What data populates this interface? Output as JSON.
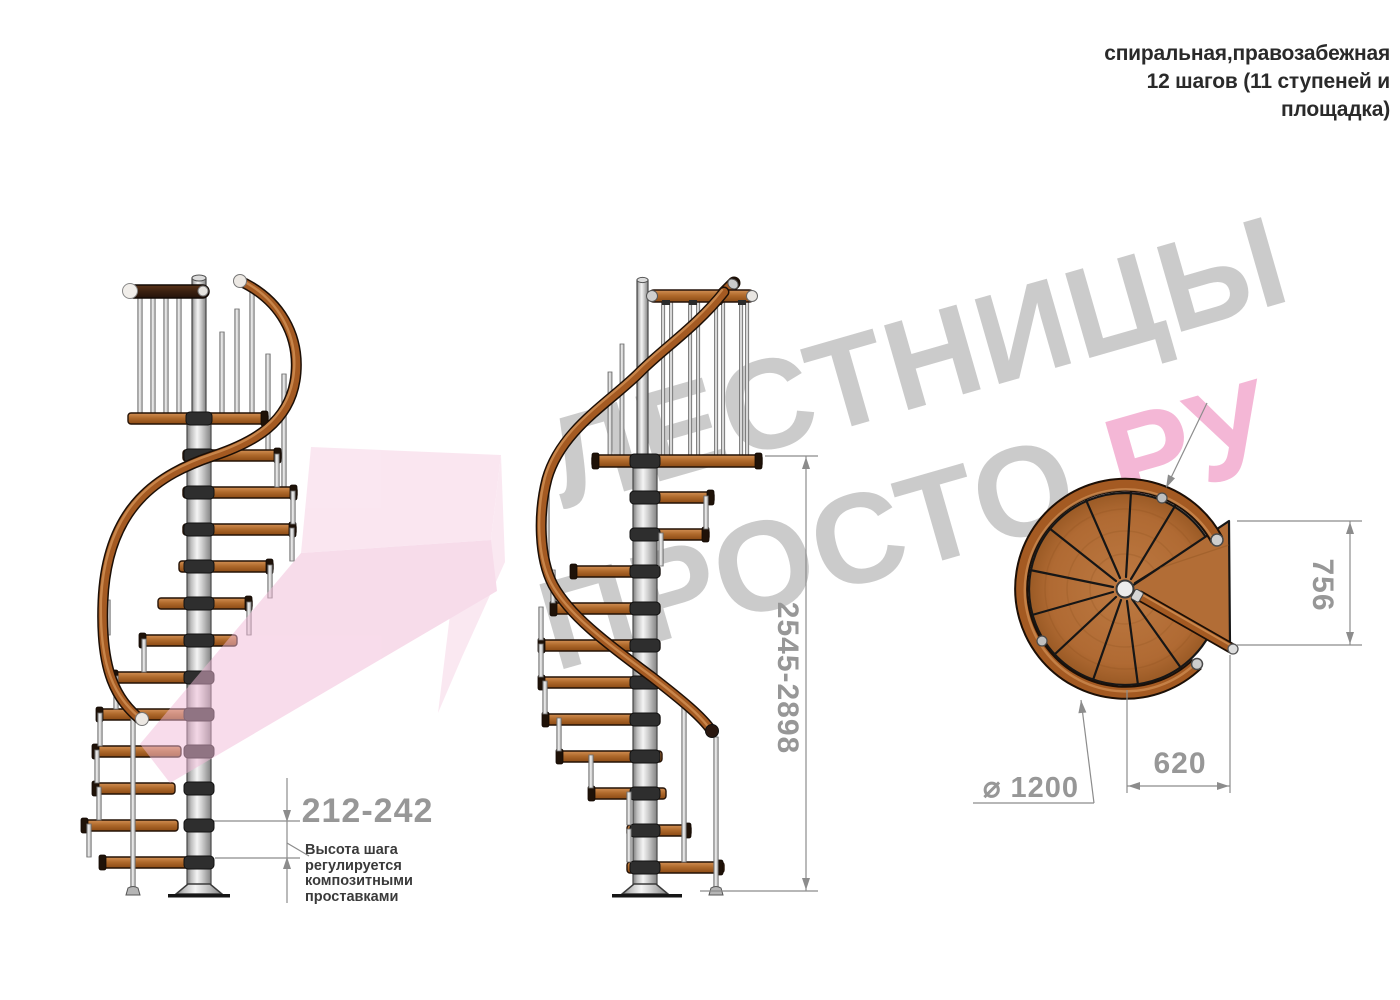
{
  "title": {
    "line1": "спиральная,правозабежная",
    "line2": "12 шагов (11 ступеней и",
    "line3": "площадка)"
  },
  "watermark": {
    "brand_line1": "ЛЕСТНИЦЫ",
    "brand_line2": "ПРОСТО",
    "brand_tld": ".РУ",
    "gray": "#c3c3c3",
    "pink": "#f3abd0",
    "arrow_pink": "#f1bad7"
  },
  "dimensions": {
    "step_height": "212-242",
    "step_height_note": "Высота шага\nрегулируется\nкомпозитными\nпроставками",
    "total_height": "2545-2898",
    "landing_width": "756",
    "landing_depth": "620",
    "diameter": "⌀ 1200"
  },
  "drawing": {
    "type": "спиральная лестница, правозабежная",
    "rises_total": 12,
    "treads": 11,
    "has_landing": true,
    "views": [
      "боковой вид 1",
      "боковой вид 2",
      "вид сверху"
    ],
    "colors": {
      "wood": "#b06a2c",
      "wood_light": "#cd8848",
      "wood_dark": "#8a4a14",
      "dark_rail": "#3a2010",
      "pole": "#d0d0d0",
      "dim_gray": "#979797",
      "note_text": "#3a3a3a",
      "title_text": "#2a2a2a"
    }
  }
}
